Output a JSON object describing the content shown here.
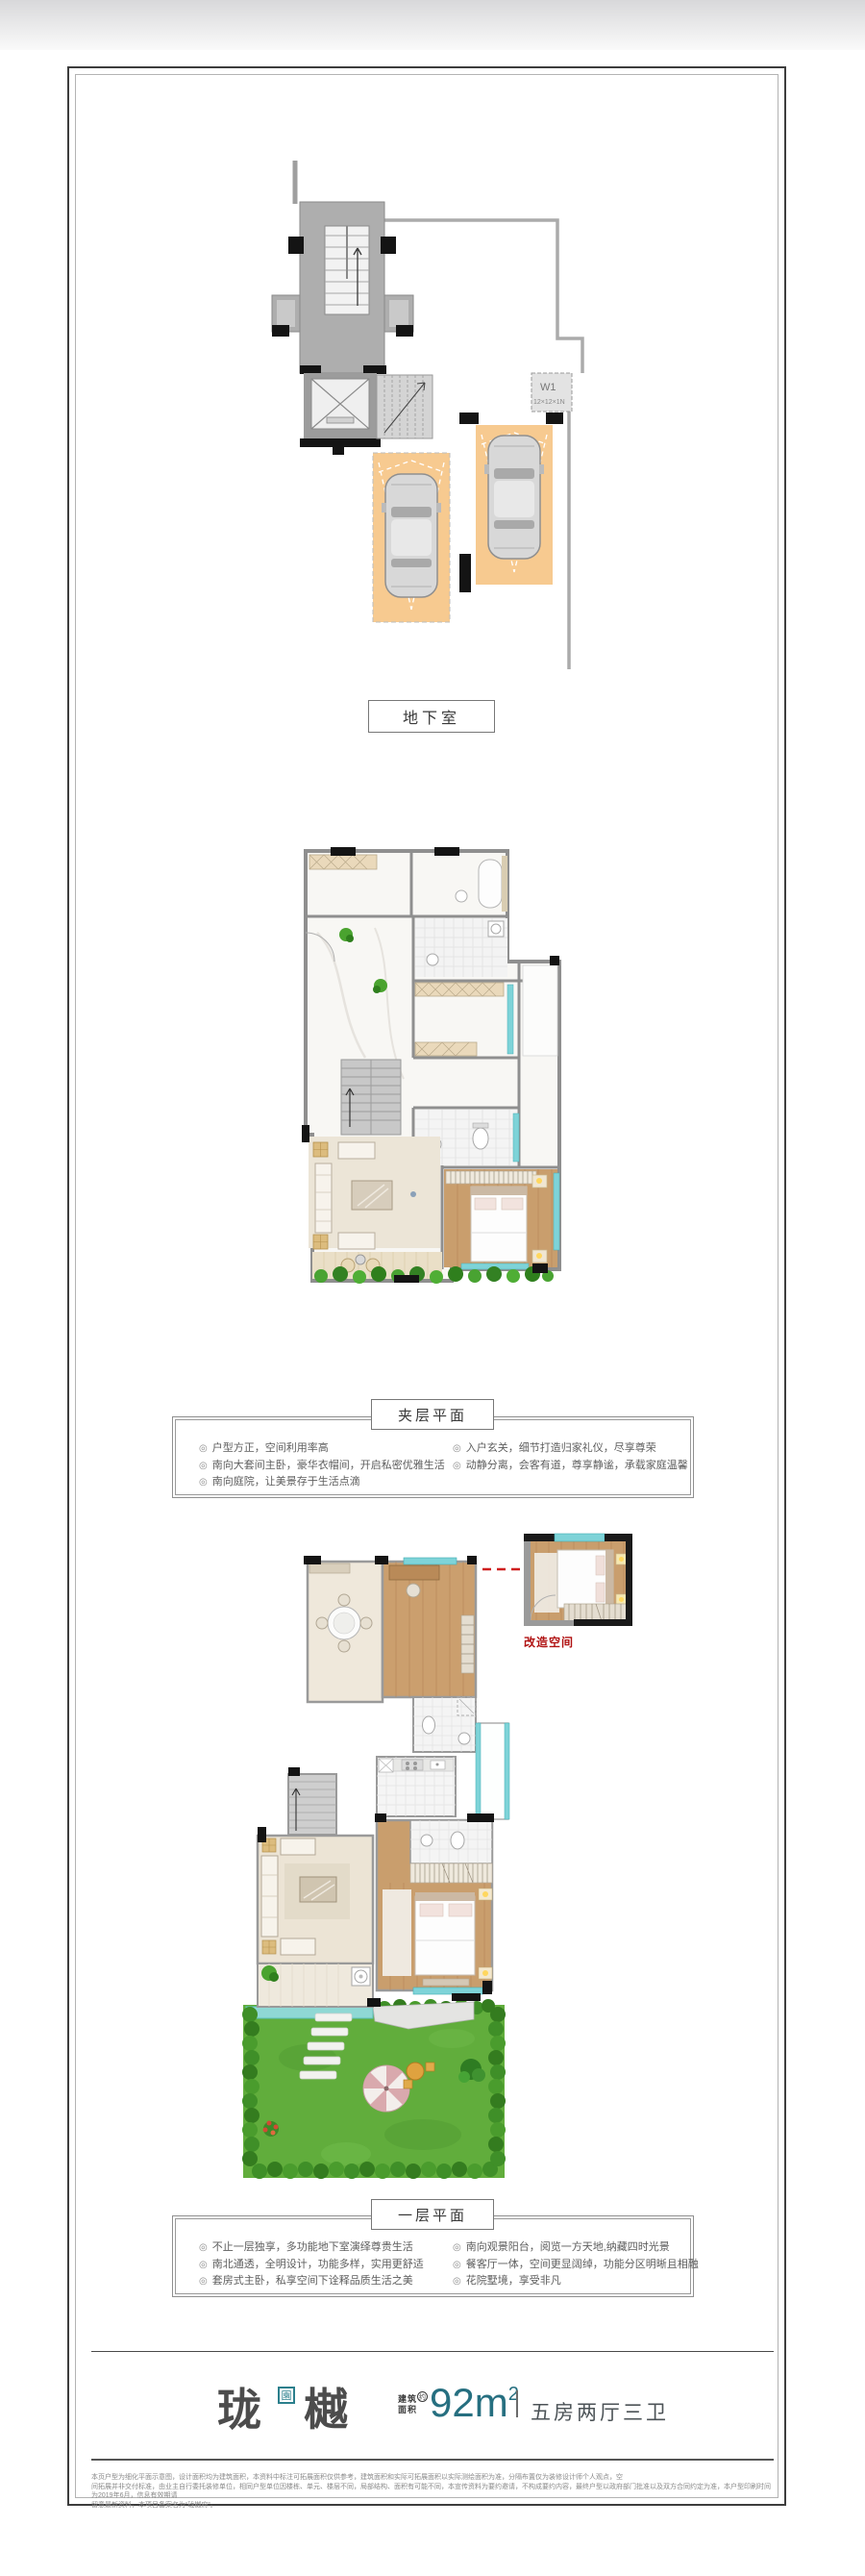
{
  "sections": {
    "basement": {
      "label": "地下室"
    },
    "mezzanine": {
      "label": "夹层平面",
      "bullets_left": [
        "户型方正，空间利用率高",
        "南向大套间主卧，豪华衣帽间，开启私密优雅生活",
        "南向庭院，让美景存于生活点滴"
      ],
      "bullets_right": [
        "入户玄关，细节打造归家礼仪，尽享尊荣",
        "动静分离，会客有道，尊享静谧，承载家庭温馨"
      ]
    },
    "floor1": {
      "label": "一层平面",
      "annotation": "改造空间",
      "bullets_left": [
        "不止一层独享，多功能地下室演绎尊贵生活",
        "南北通透，全明设计，功能多样，实用更舒适",
        "套房式主卧，私享空间下诠释品质生活之美"
      ],
      "bullets_right": [
        "南向观景阳台，阅览一方天地,纳藏四时光景",
        "餐客厅一体，空间更显阔绰，功能分区明晰且相融",
        "花院墅境，享受非凡"
      ]
    }
  },
  "basement_plan": {
    "legend_code": "W1",
    "legend_size": "12×12×1N"
  },
  "footer": {
    "brand_first": "珑",
    "brand_second": "樾",
    "brand_seal": "園",
    "area_label_top": "建筑",
    "area_label_bottom": "面积",
    "area_approx": "约",
    "area_value": "92m",
    "area_superscript": "2",
    "divider": "",
    "layout_spec": "五房两厅三卫"
  },
  "disclaimer": {
    "line1": "本页户型为细化平面示意图，设计面积均为建筑面积，本资料中标注可拓展面积仅供参考，建筑面积和实际可拓展面积以实际测绘面积为准，分隔布置仅为装修设计师个人观点，空",
    "line2": "间拓展并非交付标准，由业主自行委托装修单位，相同户型单位因楼栋、单元、楼层不同，局部结构、面积有可能不同，本宣传资料为要约邀请，不构成要约内容，最终户型以政府部门批准以及双方合同约定为准，本户型印刷时间为2019年6月，信息有效期请",
    "line3": "留意最新资料，本项目备案名为“珑樾府”。"
  },
  "ui": {
    "bullet_icon": "◎"
  },
  "colors": {
    "accent_teal": "#266f80",
    "seal_teal": "#2b7f8c",
    "window_cyan": "#7ed3d8",
    "parking_orange": "#f7ca90",
    "garden_green": "#5fae3c",
    "annotation_red": "#b01212",
    "wood_floor": "#c99e6d",
    "wall_gray": "#8f8f8f"
  }
}
